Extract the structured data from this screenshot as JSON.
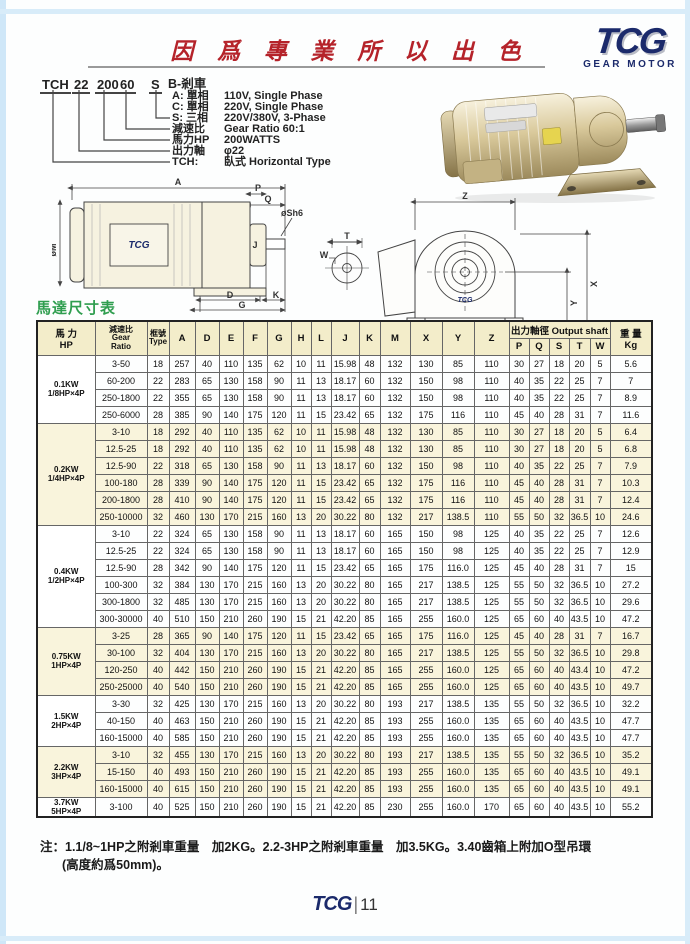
{
  "header": {
    "slogan": "因 爲 專 業  所 以 出 色",
    "logo_text": "TCG",
    "logo_subtext": "GEAR MOTOR"
  },
  "model_code": {
    "tokens": [
      "TCH",
      "22",
      "200",
      "60",
      "S"
    ],
    "brake_label": "B-剎車",
    "lines": [
      {
        "label": "A: 單相",
        "value": "110V, Single Phase"
      },
      {
        "label": "C: 單相",
        "value": "220V, Single Phase"
      },
      {
        "label": "S: 三相",
        "value": "220V/380V, 3-Phase"
      },
      {
        "label": "減速比",
        "value": "Gear Ratio 60:1"
      },
      {
        "label": "馬力HP",
        "value": "200WATTS"
      },
      {
        "label": "出力軸",
        "value": "φ22"
      },
      {
        "label": "TCH:",
        "value": "臥式 Horizontal Type"
      }
    ]
  },
  "drawings": {
    "brand": "TCG",
    "side_dims": {
      "A": "A",
      "M": "øM",
      "P": "P",
      "Q": "Q",
      "SH": "øSh6",
      "J": "J",
      "D": "D",
      "K": "K",
      "G": "G"
    },
    "front_dims": {
      "Z": "Z",
      "T": "T",
      "W": "W",
      "X": "X",
      "Y": "Y",
      "E": "E",
      "F": "F",
      "HOLES": "4-ØH"
    }
  },
  "table": {
    "title": "馬達尺寸表",
    "header": {
      "hp": [
        "馬 力",
        "HP"
      ],
      "ratio": [
        "減速比",
        "Gear",
        "Ratio"
      ],
      "type": [
        "框號",
        "Type"
      ],
      "dims": [
        "A",
        "D",
        "E",
        "F",
        "G",
        "H",
        "L",
        "J",
        "K",
        "M",
        "X",
        "Y",
        "Z"
      ],
      "output_shaft": "出力軸徑 Output shaft",
      "shaft_cols": [
        "P",
        "Q",
        "S",
        "T",
        "W"
      ],
      "weight": [
        "重 量",
        "Kg"
      ]
    },
    "groups": [
      {
        "hp": [
          "0.1KW",
          "1/8HP×4P"
        ],
        "shaded": false,
        "rows": [
          [
            "3-50",
            "18",
            "257",
            "40",
            "110",
            "135",
            "62",
            "10",
            "11",
            "15.98",
            "48",
            "132",
            "130",
            "85",
            "110",
            "30",
            "27",
            "18",
            "20",
            "5",
            "5.6"
          ],
          [
            "60-200",
            "22",
            "283",
            "65",
            "130",
            "158",
            "90",
            "11",
            "13",
            "18.17",
            "60",
            "132",
            "150",
            "98",
            "110",
            "40",
            "35",
            "22",
            "25",
            "7",
            "7"
          ],
          [
            "250-1800",
            "22",
            "355",
            "65",
            "130",
            "158",
            "90",
            "11",
            "13",
            "18.17",
            "60",
            "132",
            "150",
            "98",
            "110",
            "40",
            "35",
            "22",
            "25",
            "7",
            "8.9"
          ],
          [
            "250-6000",
            "28",
            "385",
            "90",
            "140",
            "175",
            "120",
            "11",
            "15",
            "23.42",
            "65",
            "132",
            "175",
            "116",
            "110",
            "45",
            "40",
            "28",
            "31",
            "7",
            "11.6"
          ]
        ]
      },
      {
        "hp": [
          "0.2KW",
          "1/4HP×4P"
        ],
        "shaded": true,
        "rows": [
          [
            "3-10",
            "18",
            "292",
            "40",
            "110",
            "135",
            "62",
            "10",
            "11",
            "15.98",
            "48",
            "132",
            "130",
            "85",
            "110",
            "30",
            "27",
            "18",
            "20",
            "5",
            "6.4"
          ],
          [
            "12.5-25",
            "18",
            "292",
            "40",
            "110",
            "135",
            "62",
            "10",
            "11",
            "15.98",
            "48",
            "132",
            "130",
            "85",
            "110",
            "30",
            "27",
            "18",
            "20",
            "5",
            "6.8"
          ],
          [
            "12.5-90",
            "22",
            "318",
            "65",
            "130",
            "158",
            "90",
            "11",
            "13",
            "18.17",
            "60",
            "132",
            "150",
            "98",
            "110",
            "40",
            "35",
            "22",
            "25",
            "7",
            "7.9"
          ],
          [
            "100-180",
            "28",
            "339",
            "90",
            "140",
            "175",
            "120",
            "11",
            "15",
            "23.42",
            "65",
            "132",
            "175",
            "116",
            "110",
            "45",
            "40",
            "28",
            "31",
            "7",
            "10.3"
          ],
          [
            "200-1800",
            "28",
            "410",
            "90",
            "140",
            "175",
            "120",
            "11",
            "15",
            "23.42",
            "65",
            "132",
            "175",
            "116",
            "110",
            "45",
            "40",
            "28",
            "31",
            "7",
            "12.4"
          ],
          [
            "250-10000",
            "32",
            "460",
            "130",
            "170",
            "215",
            "160",
            "13",
            "20",
            "30.22",
            "80",
            "132",
            "217",
            "138.5",
            "110",
            "55",
            "50",
            "32",
            "36.5",
            "10",
            "24.6"
          ]
        ]
      },
      {
        "hp": [
          "0.4KW",
          "1/2HP×4P"
        ],
        "shaded": false,
        "rows": [
          [
            "3-10",
            "22",
            "324",
            "65",
            "130",
            "158",
            "90",
            "11",
            "13",
            "18.17",
            "60",
            "165",
            "150",
            "98",
            "125",
            "40",
            "35",
            "22",
            "25",
            "7",
            "12.6"
          ],
          [
            "12.5-25",
            "22",
            "324",
            "65",
            "130",
            "158",
            "90",
            "11",
            "13",
            "18.17",
            "60",
            "165",
            "150",
            "98",
            "125",
            "40",
            "35",
            "22",
            "25",
            "7",
            "12.9"
          ],
          [
            "12.5-90",
            "28",
            "342",
            "90",
            "140",
            "175",
            "120",
            "11",
            "15",
            "23.42",
            "65",
            "165",
            "175",
            "116.0",
            "125",
            "45",
            "40",
            "28",
            "31",
            "7",
            "15"
          ],
          [
            "100-300",
            "32",
            "384",
            "130",
            "170",
            "215",
            "160",
            "13",
            "20",
            "30.22",
            "80",
            "165",
            "217",
            "138.5",
            "125",
            "55",
            "50",
            "32",
            "36.5",
            "10",
            "27.2"
          ],
          [
            "300-1800",
            "32",
            "485",
            "130",
            "170",
            "215",
            "160",
            "13",
            "20",
            "30.22",
            "80",
            "165",
            "217",
            "138.5",
            "125",
            "55",
            "50",
            "32",
            "36.5",
            "10",
            "29.6"
          ],
          [
            "300-30000",
            "40",
            "510",
            "150",
            "210",
            "260",
            "190",
            "15",
            "21",
            "42.20",
            "85",
            "165",
            "255",
            "160.0",
            "125",
            "65",
            "60",
            "40",
            "43.5",
            "10",
            "47.2"
          ]
        ]
      },
      {
        "hp": [
          "0.75KW",
          "1HP×4P"
        ],
        "shaded": true,
        "rows": [
          [
            "3-25",
            "28",
            "365",
            "90",
            "140",
            "175",
            "120",
            "11",
            "15",
            "23.42",
            "65",
            "165",
            "175",
            "116.0",
            "125",
            "45",
            "40",
            "28",
            "31",
            "7",
            "16.7"
          ],
          [
            "30-100",
            "32",
            "404",
            "130",
            "170",
            "215",
            "160",
            "13",
            "20",
            "30.22",
            "80",
            "165",
            "217",
            "138.5",
            "125",
            "55",
            "50",
            "32",
            "36.5",
            "10",
            "29.8"
          ],
          [
            "120-250",
            "40",
            "442",
            "150",
            "210",
            "260",
            "190",
            "15",
            "21",
            "42.20",
            "85",
            "165",
            "255",
            "160.0",
            "125",
            "65",
            "60",
            "40",
            "43.4",
            "10",
            "47.2"
          ],
          [
            "250-25000",
            "40",
            "540",
            "150",
            "210",
            "260",
            "190",
            "15",
            "21",
            "42.20",
            "85",
            "165",
            "255",
            "160.0",
            "125",
            "65",
            "60",
            "40",
            "43.5",
            "10",
            "49.7"
          ]
        ]
      },
      {
        "hp": [
          "1.5KW",
          "2HP×4P"
        ],
        "shaded": false,
        "rows": [
          [
            "3-30",
            "32",
            "425",
            "130",
            "170",
            "215",
            "160",
            "13",
            "20",
            "30.22",
            "80",
            "193",
            "217",
            "138.5",
            "135",
            "55",
            "50",
            "32",
            "36.5",
            "10",
            "32.2"
          ],
          [
            "40-150",
            "40",
            "463",
            "150",
            "210",
            "260",
            "190",
            "15",
            "21",
            "42.20",
            "85",
            "193",
            "255",
            "160.0",
            "135",
            "65",
            "60",
            "40",
            "43.5",
            "10",
            "47.7"
          ],
          [
            "160-15000",
            "40",
            "585",
            "150",
            "210",
            "260",
            "190",
            "15",
            "21",
            "42.20",
            "85",
            "193",
            "255",
            "160.0",
            "135",
            "65",
            "60",
            "40",
            "43.5",
            "10",
            "47.7"
          ]
        ]
      },
      {
        "hp": [
          "2.2KW",
          "3HP×4P"
        ],
        "shaded": true,
        "rows": [
          [
            "3-10",
            "32",
            "455",
            "130",
            "170",
            "215",
            "160",
            "13",
            "20",
            "30.22",
            "80",
            "193",
            "217",
            "138.5",
            "135",
            "55",
            "50",
            "32",
            "36.5",
            "10",
            "35.2"
          ],
          [
            "15-150",
            "40",
            "493",
            "150",
            "210",
            "260",
            "190",
            "15",
            "21",
            "42.20",
            "85",
            "193",
            "255",
            "160.0",
            "135",
            "65",
            "60",
            "40",
            "43.5",
            "10",
            "49.1"
          ],
          [
            "160-15000",
            "40",
            "615",
            "150",
            "210",
            "260",
            "190",
            "15",
            "21",
            "42.20",
            "85",
            "193",
            "255",
            "160.0",
            "135",
            "65",
            "60",
            "40",
            "43.5",
            "10",
            "49.1"
          ]
        ]
      },
      {
        "hp": [
          "3.7KW",
          "5HP×4P"
        ],
        "shaded": false,
        "rows": [
          [
            "3-100",
            "40",
            "525",
            "150",
            "210",
            "260",
            "190",
            "15",
            "21",
            "42.20",
            "85",
            "230",
            "255",
            "160.0",
            "170",
            "65",
            "60",
            "40",
            "43.5",
            "10",
            "55.2"
          ]
        ]
      }
    ]
  },
  "notes": {
    "line1": "注：1.1/8~1HP之附剎車重量　加2KG。2.2-3HP之附剎車重量　加3.5KG。3.40齒箱上附加O型吊環",
    "line2": "(高度約爲50mm)。"
  },
  "footer": {
    "logo": "TCG",
    "separator": "|",
    "page": "11"
  },
  "colors": {
    "accent_red": "#b5232a",
    "brand_navy": "#1b2a6b",
    "title_green": "#2f9e4f",
    "table_cream": "#f3edca",
    "row_cream": "#f9f4dc",
    "frame_blue": "#cfe7f8"
  }
}
